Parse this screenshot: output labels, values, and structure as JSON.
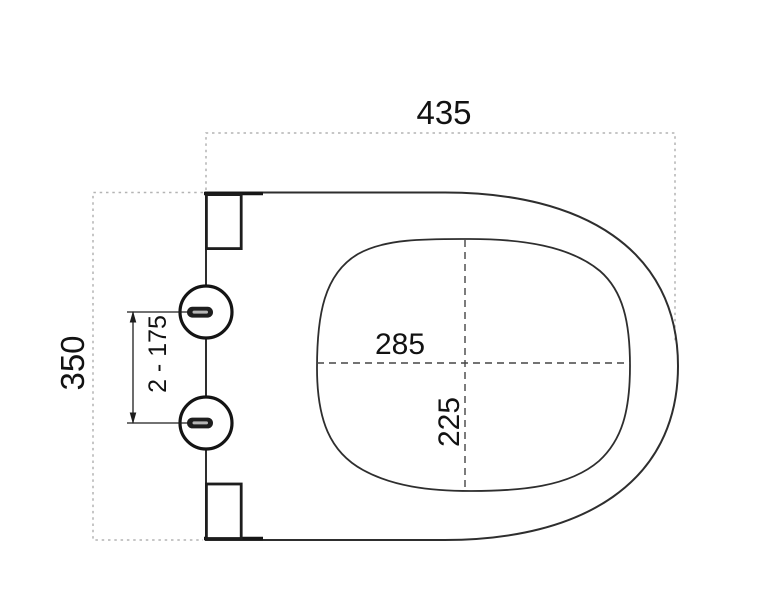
{
  "diagram": {
    "type": "technical-dimension-drawing",
    "labels": {
      "overall_width": "435",
      "overall_depth": "350",
      "inner_width": "285",
      "inner_depth": "225",
      "hinge_hole_spacing": "2 - 175"
    },
    "colors": {
      "background": "#ffffff",
      "outline": "#2e2e2e",
      "thick_line": "#161616",
      "dashed_centerline": "#454545",
      "dotted_extension": "#b4b4b4",
      "text": "#121212",
      "slot_fill": "#1e1e1e",
      "slot_slit": "#b6b6b6"
    }
  }
}
